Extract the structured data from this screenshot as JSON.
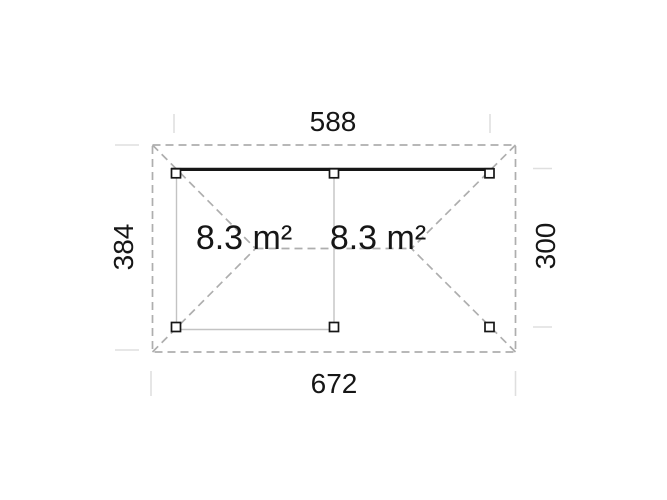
{
  "plan": {
    "dim_top": "588",
    "dim_bottom": "672",
    "dim_left": "384",
    "dim_right": "300",
    "area_left": "8.3 m²",
    "area_right": "8.3 m²"
  },
  "colors": {
    "background": "#ffffff",
    "roof-dash": "#aeaeae",
    "wall": "#c3c3c3",
    "extension": "#dfdfdf",
    "structure": "#161616",
    "text": "#161616"
  }
}
